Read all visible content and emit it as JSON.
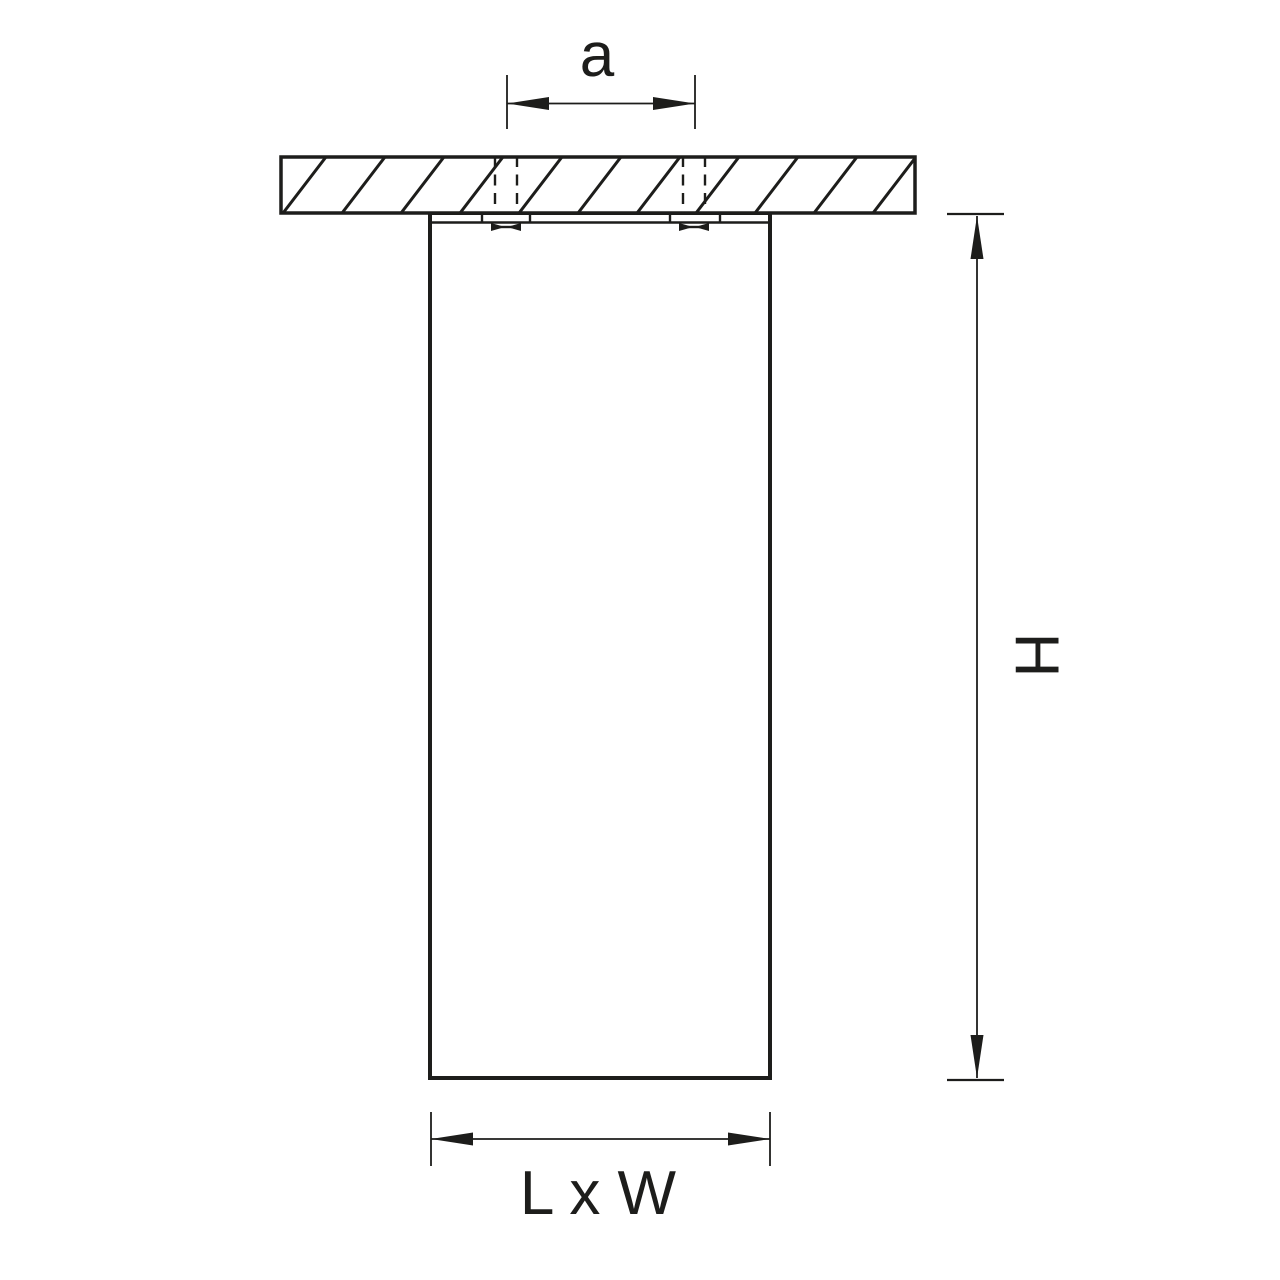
{
  "meta": {
    "type": "technical-dimension-drawing",
    "subject": "ceiling-mounted-cylindrical-luminaire-side-view",
    "background_color": "#ffffff",
    "line_color": "#1d1d1b"
  },
  "dimensions": {
    "hole_spacing_label": "a",
    "height_label": "H",
    "footprint_label": "L x W"
  },
  "parts": {
    "ceiling": "hatched-ceiling-section",
    "bracket": "mounting-bracket-strip",
    "screws": "two-dashed-mounting-screws",
    "body": "fixture-body-rectangle"
  }
}
